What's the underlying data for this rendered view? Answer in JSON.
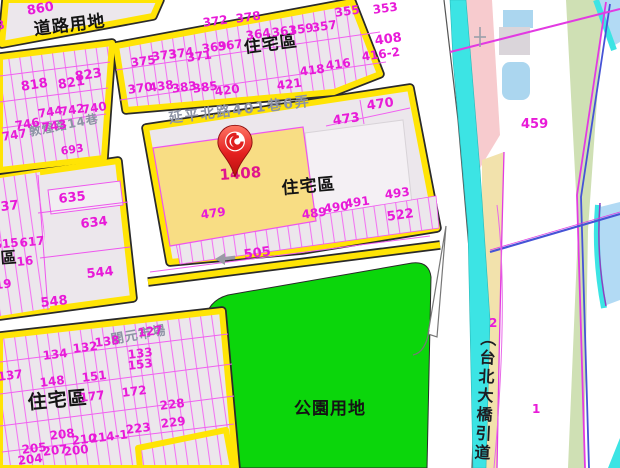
{
  "map": {
    "zones": {
      "road_zone": "道路用地",
      "residential_top": "住宅區",
      "residential_center": "住宅區",
      "residential_left_edge": "宅區",
      "residential_bottom": "住宅區",
      "park": "公園用地",
      "bridge_ramp_vertical": "（台北大橋引道"
    },
    "streets": {
      "left_street": "敦煌路14巷",
      "center_street": "延平北路401巷6弄",
      "market": "開元市場"
    },
    "highlight": {
      "parcel_number": "1408",
      "fill_color": "#f8dd84"
    },
    "colors": {
      "road_casing_yellow": "#ffe405",
      "parcel_fill": "#ece7ec",
      "parcel_line_magenta": "#f373f3",
      "parcel_number_magenta": "#e81ad8",
      "park_green": "#0bd60b",
      "canal_cyan": "#3ce4e4",
      "water_blue": "#b2daf4",
      "ramp_pink": "#f7cbce",
      "ramp_tan": "#f2e2ac",
      "pin_red": "#d41414"
    },
    "parcel_numbers": [
      {
        "t": "860",
        "x": 26,
        "y": 5,
        "s": 13,
        "r": -10
      },
      {
        "t": "8",
        "x": -5,
        "y": 20,
        "s": 12,
        "r": -10
      },
      {
        "t": "823",
        "x": 74,
        "y": 71,
        "s": 13,
        "r": -9
      },
      {
        "t": "818",
        "x": 20,
        "y": 81,
        "s": 13,
        "r": -9
      },
      {
        "t": "821",
        "x": 57,
        "y": 79,
        "s": 13,
        "r": -9
      },
      {
        "t": "744",
        "x": 37,
        "y": 108,
        "s": 12,
        "r": -9
      },
      {
        "t": "742",
        "x": 59,
        "y": 106,
        "s": 12,
        "r": -9
      },
      {
        "t": "740",
        "x": 81,
        "y": 104,
        "s": 12,
        "r": -9
      },
      {
        "t": "746",
        "x": 14,
        "y": 120,
        "s": 12,
        "r": -9
      },
      {
        "t": "743",
        "x": 41,
        "y": 122,
        "s": 12,
        "r": -9
      },
      {
        "t": "747",
        "x": 1,
        "y": 131,
        "s": 12,
        "r": -9
      },
      {
        "t": "693",
        "x": 60,
        "y": 146,
        "s": 11,
        "r": -9
      },
      {
        "t": "372",
        "x": 202,
        "y": 17,
        "s": 12,
        "r": -8
      },
      {
        "t": "378",
        "x": 235,
        "y": 13,
        "s": 12,
        "r": -8
      },
      {
        "t": "364",
        "x": 245,
        "y": 30,
        "s": 12,
        "r": -8
      },
      {
        "t": "361",
        "x": 271,
        "y": 27,
        "s": 12,
        "r": -8
      },
      {
        "t": "359",
        "x": 288,
        "y": 25,
        "s": 12,
        "r": -8
      },
      {
        "t": "357",
        "x": 311,
        "y": 22,
        "s": 12,
        "r": -8
      },
      {
        "t": "355",
        "x": 334,
        "y": 7,
        "s": 12,
        "r": -8
      },
      {
        "t": "353",
        "x": 372,
        "y": 4,
        "s": 12,
        "r": -8
      },
      {
        "t": "408",
        "x": 374,
        "y": 35,
        "s": 13,
        "r": -8
      },
      {
        "t": "416-2",
        "x": 361,
        "y": 51,
        "s": 12,
        "r": -8
      },
      {
        "t": "416",
        "x": 325,
        "y": 60,
        "s": 12,
        "r": -8
      },
      {
        "t": "418",
        "x": 299,
        "y": 66,
        "s": 12,
        "r": -8
      },
      {
        "t": "369",
        "x": 201,
        "y": 43,
        "s": 12,
        "r": -8
      },
      {
        "t": "367",
        "x": 217,
        "y": 41,
        "s": 12,
        "r": -8
      },
      {
        "t": "373",
        "x": 151,
        "y": 51,
        "s": 12,
        "r": -8
      },
      {
        "t": "374",
        "x": 168,
        "y": 49,
        "s": 12,
        "r": -8
      },
      {
        "t": "371",
        "x": 186,
        "y": 52,
        "s": 12,
        "r": -8
      },
      {
        "t": "375",
        "x": 130,
        "y": 57,
        "s": 12,
        "r": -8
      },
      {
        "t": "370",
        "x": 127,
        "y": 84,
        "s": 12,
        "r": -8
      },
      {
        "t": "438",
        "x": 148,
        "y": 82,
        "s": 12,
        "r": -8
      },
      {
        "t": "383",
        "x": 171,
        "y": 83,
        "s": 12,
        "r": -8
      },
      {
        "t": "385",
        "x": 192,
        "y": 83,
        "s": 12,
        "r": -8
      },
      {
        "t": "420",
        "x": 214,
        "y": 86,
        "s": 12,
        "r": -8
      },
      {
        "t": "421",
        "x": 276,
        "y": 80,
        "s": 12,
        "r": -8
      },
      {
        "t": "473",
        "x": 332,
        "y": 115,
        "s": 13,
        "r": -8
      },
      {
        "t": "470",
        "x": 366,
        "y": 100,
        "s": 13,
        "r": -8
      },
      {
        "t": "1408",
        "x": 219,
        "y": 168,
        "s": 15,
        "r": -4,
        "c": "#e0148c"
      },
      {
        "t": "493",
        "x": 384,
        "y": 189,
        "s": 12,
        "r": -8
      },
      {
        "t": "491",
        "x": 344,
        "y": 198,
        "s": 12,
        "r": -8
      },
      {
        "t": "490",
        "x": 323,
        "y": 203,
        "s": 12,
        "r": -8
      },
      {
        "t": "489",
        "x": 301,
        "y": 209,
        "s": 12,
        "r": -8
      },
      {
        "t": "522",
        "x": 386,
        "y": 211,
        "s": 13,
        "r": -8
      },
      {
        "t": "479",
        "x": 200,
        "y": 209,
        "s": 12,
        "r": -8
      },
      {
        "t": "505",
        "x": 243,
        "y": 249,
        "s": 13,
        "r": -8
      },
      {
        "t": "637",
        "x": -9,
        "y": 202,
        "s": 13,
        "r": -6
      },
      {
        "t": "635",
        "x": 58,
        "y": 193,
        "s": 13,
        "r": -6
      },
      {
        "t": "634",
        "x": 80,
        "y": 218,
        "s": 13,
        "r": -6
      },
      {
        "t": "615",
        "x": -7,
        "y": 239,
        "s": 12,
        "r": -6
      },
      {
        "t": "617",
        "x": 19,
        "y": 237,
        "s": 12,
        "r": -6
      },
      {
        "t": "16",
        "x": 16,
        "y": 256,
        "s": 12,
        "r": -6
      },
      {
        "t": "544",
        "x": 86,
        "y": 268,
        "s": 13,
        "r": -6
      },
      {
        "t": "619",
        "x": -14,
        "y": 280,
        "s": 12,
        "r": -6
      },
      {
        "t": "548",
        "x": 40,
        "y": 297,
        "s": 13,
        "r": -6
      },
      {
        "t": "137",
        "x": -3,
        "y": 371,
        "s": 12,
        "r": -7
      },
      {
        "t": "134",
        "x": 42,
        "y": 350,
        "s": 12,
        "r": -7
      },
      {
        "t": "132",
        "x": 72,
        "y": 343,
        "s": 12,
        "r": -7
      },
      {
        "t": "138",
        "x": 94,
        "y": 337,
        "s": 12,
        "r": -7
      },
      {
        "t": "127",
        "x": 137,
        "y": 327,
        "s": 12,
        "r": -7
      },
      {
        "t": "133",
        "x": 127,
        "y": 349,
        "s": 12,
        "r": -7
      },
      {
        "t": "153",
        "x": 127,
        "y": 360,
        "s": 12,
        "r": -7
      },
      {
        "t": "148",
        "x": 39,
        "y": 377,
        "s": 12,
        "r": -7
      },
      {
        "t": "151",
        "x": 81,
        "y": 372,
        "s": 12,
        "r": -7
      },
      {
        "t": "177",
        "x": 79,
        "y": 392,
        "s": 12,
        "r": -7
      },
      {
        "t": "172",
        "x": 121,
        "y": 387,
        "s": 12,
        "r": -7
      },
      {
        "t": "228",
        "x": 159,
        "y": 400,
        "s": 12,
        "r": -7
      },
      {
        "t": "229",
        "x": 160,
        "y": 418,
        "s": 12,
        "r": -7
      },
      {
        "t": "223",
        "x": 125,
        "y": 424,
        "s": 12,
        "r": -7
      },
      {
        "t": "208",
        "x": 49,
        "y": 430,
        "s": 12,
        "r": -7
      },
      {
        "t": "210",
        "x": 71,
        "y": 435,
        "s": 12,
        "r": -7
      },
      {
        "t": "214-1",
        "x": 89,
        "y": 433,
        "s": 12,
        "r": -7
      },
      {
        "t": "205",
        "x": 21,
        "y": 444,
        "s": 12,
        "r": -7
      },
      {
        "t": "207",
        "x": 42,
        "y": 446,
        "s": 12,
        "r": -7
      },
      {
        "t": "200",
        "x": 63,
        "y": 446,
        "s": 12,
        "r": -7
      },
      {
        "t": "204",
        "x": 17,
        "y": 455,
        "s": 12,
        "r": -7
      },
      {
        "t": "459",
        "x": 521,
        "y": 118,
        "s": 13,
        "r": 0
      },
      {
        "t": "2",
        "x": 489,
        "y": 317,
        "s": 12,
        "r": 0
      },
      {
        "t": "1",
        "x": 532,
        "y": 403,
        "s": 12,
        "r": 0
      }
    ]
  }
}
